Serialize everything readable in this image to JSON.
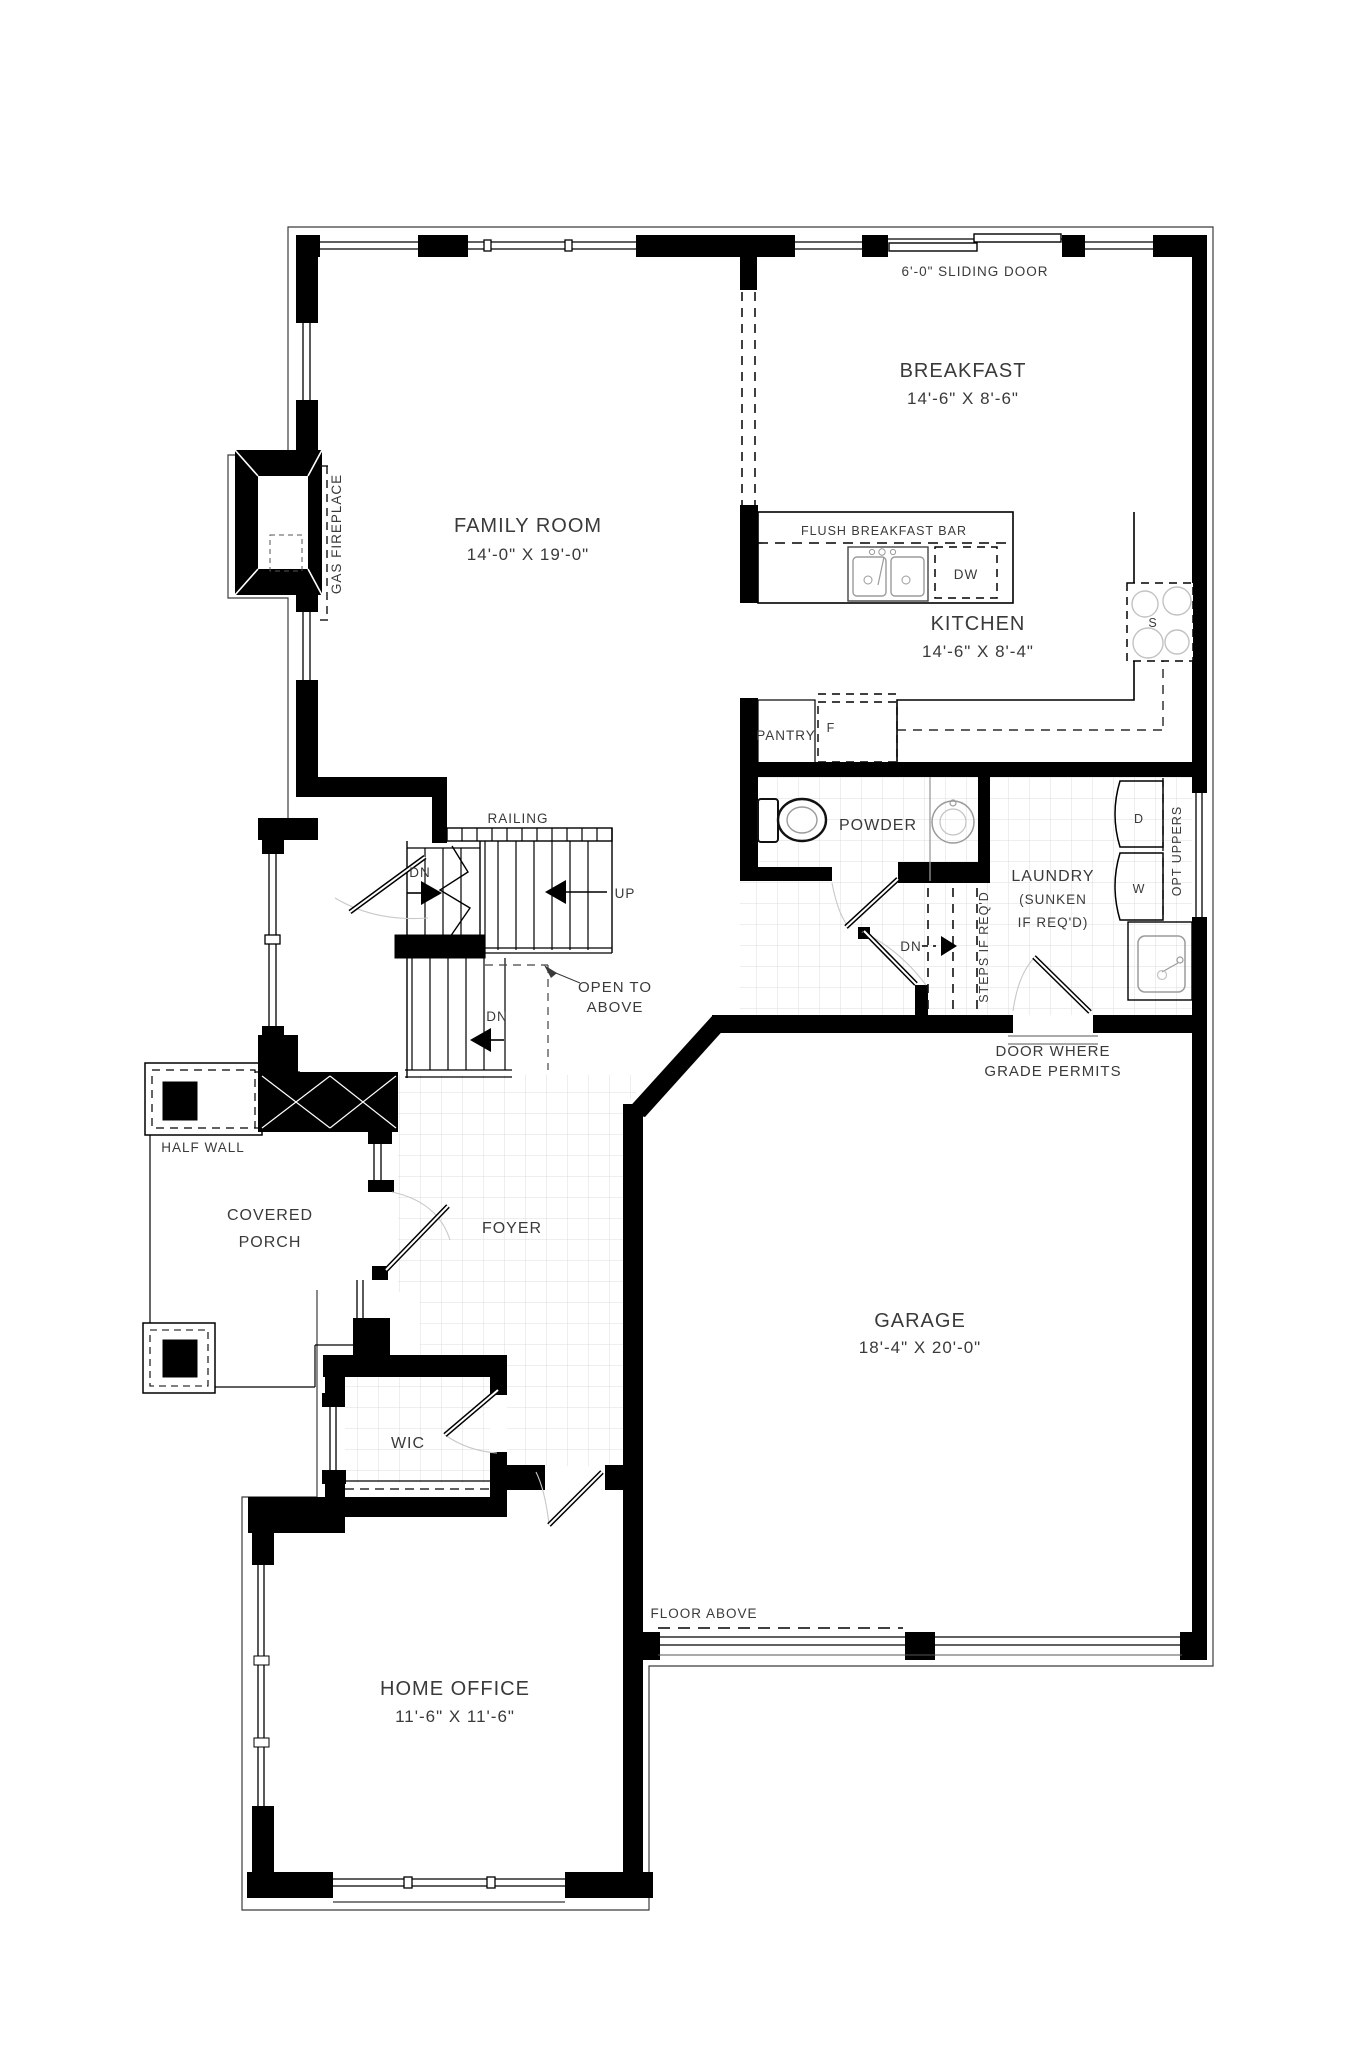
{
  "plan_title": "First Floor Plan",
  "colors": {
    "wall": "#000000",
    "text": "#3a3a3a",
    "tile": "#dcdcdc",
    "fixture": "#9b9b9b",
    "swing_arc": "#c8c8c8"
  },
  "rooms": {
    "family_room": {
      "name": "FAMILY ROOM",
      "dims": "14'-0\" X 19'-0\""
    },
    "breakfast": {
      "name": "BREAKFAST",
      "dims": "14'-6\" X 8'-6\""
    },
    "kitchen": {
      "name": "KITCHEN",
      "dims": "14'-6\" X 8'-4\""
    },
    "powder": {
      "name": "POWDER"
    },
    "laundry": {
      "name": "LAUNDRY",
      "note1": "(SUNKEN",
      "note2": "IF REQ'D)"
    },
    "garage": {
      "name": "GARAGE",
      "dims": "18'-4\" X 20'-0\""
    },
    "foyer": {
      "name": "FOYER"
    },
    "wic": {
      "name": "WIC"
    },
    "home_office": {
      "name": "HOME OFFICE",
      "dims": "11'-6\" X 11'-6\""
    },
    "covered_porch": {
      "line1": "COVERED",
      "line2": "PORCH"
    }
  },
  "labels": {
    "sliding_door": "6'-0\" SLIDING DOOR",
    "gas_fireplace": "GAS FIREPLACE",
    "flush_breakfast_bar": "FLUSH BREAKFAST BAR",
    "pantry": "PANTRY",
    "fridge": "F",
    "dishwasher": "DW",
    "stove": "S",
    "dryer": "D",
    "washer": "W",
    "opt_uppers": "OPT UPPERS",
    "steps_if_reqd": "STEPS IF REQ'D",
    "dn": "DN",
    "up": "UP",
    "railing": "RAILING",
    "open_to": "OPEN TO",
    "above": "ABOVE",
    "half_wall": "HALF WALL",
    "door_where": "DOOR WHERE",
    "grade_permits": "GRADE PERMITS",
    "floor_above": "FLOOR ABOVE"
  }
}
